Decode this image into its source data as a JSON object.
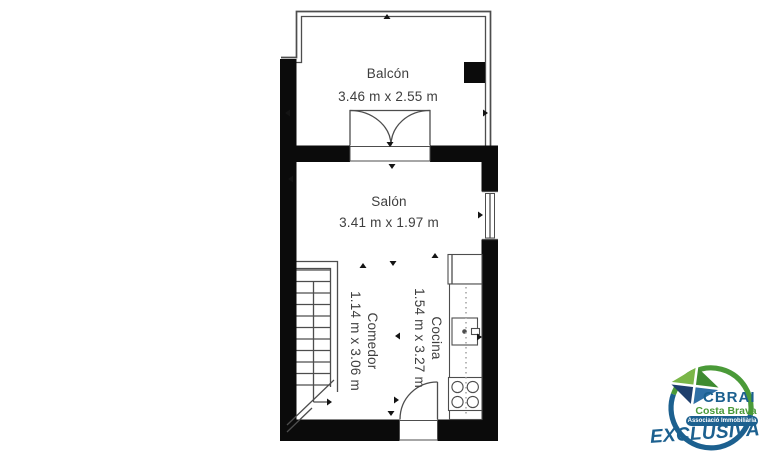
{
  "figure": {
    "type": "floor-plan"
  },
  "rooms": {
    "balcon": {
      "name": "Balcón",
      "dims": "3.46 m x 2.55 m"
    },
    "salon": {
      "name": "Salón",
      "dims": "3.41 m x 1.97 m"
    },
    "comedor": {
      "name": "Comedor",
      "dims": "1.14 m x 3.06 m"
    },
    "cocina": {
      "name": "Cocina",
      "dims": "1.54 m x 3.27 m"
    }
  },
  "logo": {
    "brand": "CBRAI",
    "region": "Costa Brava",
    "association": "Associació Immobiliària",
    "banner": "EXCLUSIVA"
  },
  "colors": {
    "wall": "#0b0b0b",
    "line": "#4d4d4d",
    "text": "#3e3e3e",
    "logo-blue": "#1c608f",
    "logo-green": "#4a9a38",
    "logo-light-green": "#7ab648",
    "logo-dark-green": "#3e8b31",
    "logo-navy": "#1e3f6d",
    "logo-mid-blue": "#2f6fa5"
  }
}
